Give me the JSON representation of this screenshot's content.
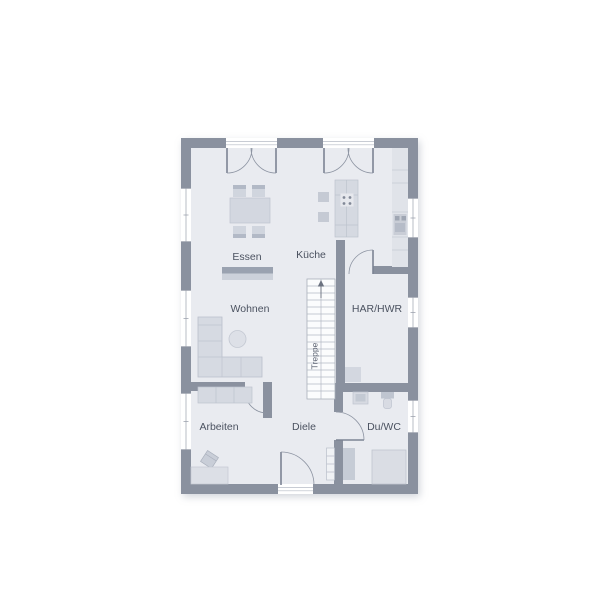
{
  "plan": {
    "type": "floor-plan-ground-floor",
    "labels": {
      "essen": "Essen",
      "kueche": "Küche",
      "wohnen": "Wohnen",
      "har_hwr": "HAR/HWR",
      "arbeiten": "Arbeiten",
      "diele": "Diele",
      "du_wc": "Du/WC",
      "treppe": "Treppe"
    },
    "colors": {
      "wall": "#8a919f",
      "floor": "#e9ebf0",
      "furniture_light": "#d5d9e1",
      "furniture_medium": "#c6ccd6",
      "sideboard_dark": "#9aa2b0",
      "stair_fill": "#fbfcfd",
      "label_text": "#4b5260",
      "entrance_marker": "#e2401d"
    },
    "entrance": {
      "marker": "red-triangle-up",
      "location": "bottom-center"
    }
  }
}
